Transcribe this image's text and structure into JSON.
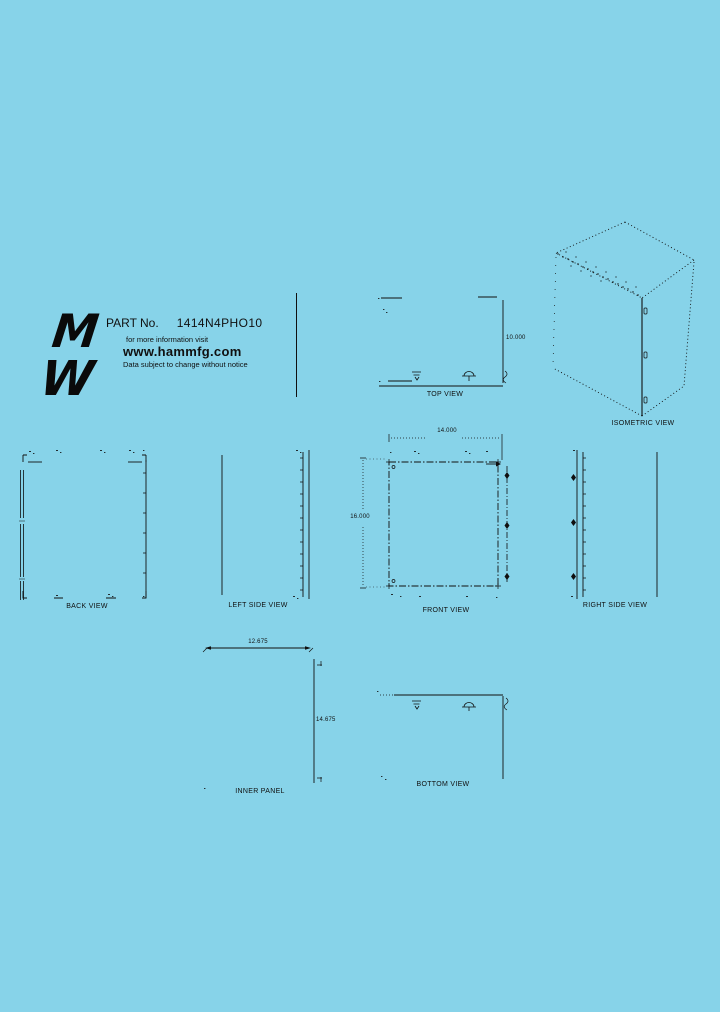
{
  "page": {
    "background": "#87D3E9",
    "line_color": "#101010"
  },
  "header": {
    "part_label": "PART No.",
    "part_number": "1414N4PHO10",
    "info_text": "for more information visit",
    "website": "www.hammfg.com",
    "notice": "Data subject to change without notice",
    "logo_top": "M",
    "logo_bottom": "W"
  },
  "views": {
    "top_view": {
      "label": "TOP VIEW",
      "depth_dim": "10.000"
    },
    "isometric_view": {
      "label": "ISOMETRIC VIEW"
    },
    "back_view": {
      "label": "BACK VIEW"
    },
    "left_side_view": {
      "label": "LEFT SIDE VIEW"
    },
    "front_view": {
      "label": "FRONT VIEW",
      "width_dim": "14.000",
      "height_dim": "16.000"
    },
    "right_side_view": {
      "label": "RIGHT SIDE VIEW"
    },
    "inner_panel": {
      "label": "INNER PANEL",
      "width_dim": "12.675",
      "height_dim": "14.675"
    },
    "bottom_view": {
      "label": "BOTTOM VIEW"
    }
  }
}
